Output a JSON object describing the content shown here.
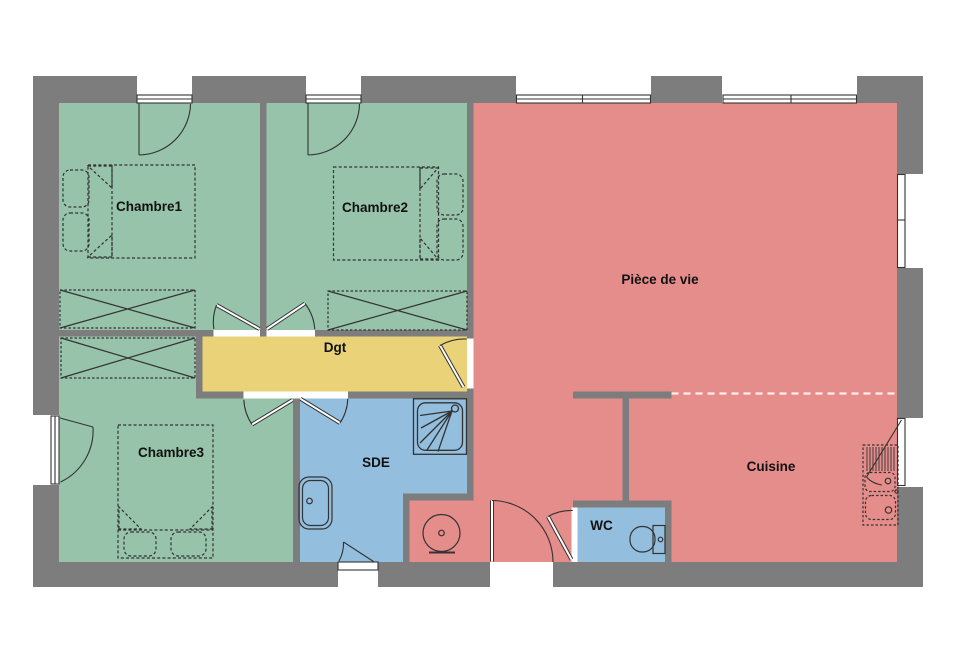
{
  "palette": {
    "wall": "#7d7d7d",
    "line": "#333333",
    "text": "#111111",
    "bedroom_green": "#96c3aa",
    "living_red": "#e58d8b",
    "corridor_yellow": "#e9d278",
    "wet_blue": "#93bedd",
    "opening_white": "#ffffff"
  },
  "rooms": [
    {
      "id": "chambre1",
      "label": "Chambre1",
      "color": "#96c3aa"
    },
    {
      "id": "chambre2",
      "label": "Chambre2",
      "color": "#96c3aa"
    },
    {
      "id": "piece-de-vie",
      "label": "Pièce de vie",
      "color": "#e58d8b"
    },
    {
      "id": "dgt",
      "label": "Dgt",
      "color": "#e9d278"
    },
    {
      "id": "chambre3",
      "label": "Chambre3",
      "color": "#96c3aa"
    },
    {
      "id": "sde",
      "label": "SDE",
      "color": "#93bedd"
    },
    {
      "id": "cuisine",
      "label": "Cuisine",
      "color": "#e58d8b"
    },
    {
      "id": "wc",
      "label": "WC",
      "color": "#93bedd"
    }
  ],
  "fixture_icons": {
    "double-bed": "dashed rectangle with headboard line, pillows and nightstands",
    "wardrobe": "dashed rectangle with X cross",
    "shower": "square tray with corner head and spray lines",
    "washbasin": "rounded basin with drain dot",
    "water-heater": "circle with center dot on base",
    "toilet": "bowl with cistern",
    "kitchen-sink": "double bowl unit with drainer hatching",
    "door": "leaf with quarter-circle swing arc",
    "window": "thin sill rectangle in wall opening"
  }
}
